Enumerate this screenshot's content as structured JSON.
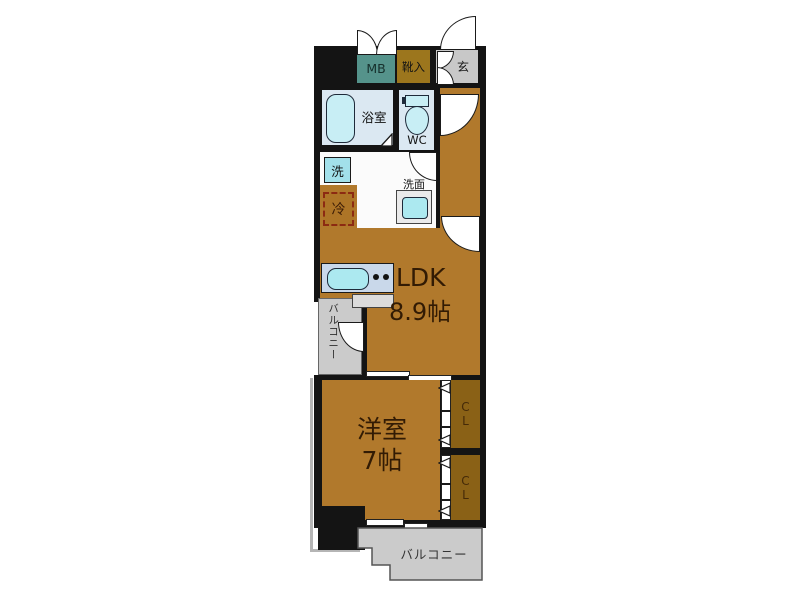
{
  "floorplan": {
    "rooms": {
      "meter_box": {
        "label": "MB"
      },
      "shoe_cabinet": {
        "label": "靴入"
      },
      "entrance": {
        "label": "玄"
      },
      "bathroom": {
        "label": "浴室"
      },
      "toilet": {
        "label": "WC"
      },
      "washer": {
        "label": "洗"
      },
      "vanity": {
        "label": "洗面"
      },
      "refrigerator": {
        "label": "冷"
      },
      "ldk": {
        "label": "LDK",
        "size": "8.9帖"
      },
      "western_room": {
        "label": "洋室",
        "size": "7帖"
      },
      "closet_upper": {
        "label": "CL"
      },
      "closet_lower": {
        "label": "CL"
      },
      "balcony_side": {
        "label": "バルコニー"
      },
      "balcony_bottom": {
        "label": "バルコニー"
      }
    },
    "colors": {
      "wall": "#141414",
      "floor_wood": "#b1792c",
      "closet_brown": "#8a6116",
      "meter_box_teal": "#55938b",
      "shoe_cabinet_gold": "#9c761d",
      "entrance_gray": "#c8c8c8",
      "balcony_gray": "#cbcbcb",
      "wet_room_blue": "#dbe8f2",
      "fixture_blue": "#c8eef5",
      "sink_cyan": "#a2e0ea",
      "kitchen_counter_blue": "#c9d8ea",
      "fridge_dash_red": "#8c2a12",
      "label_dark": "#321b04"
    }
  }
}
